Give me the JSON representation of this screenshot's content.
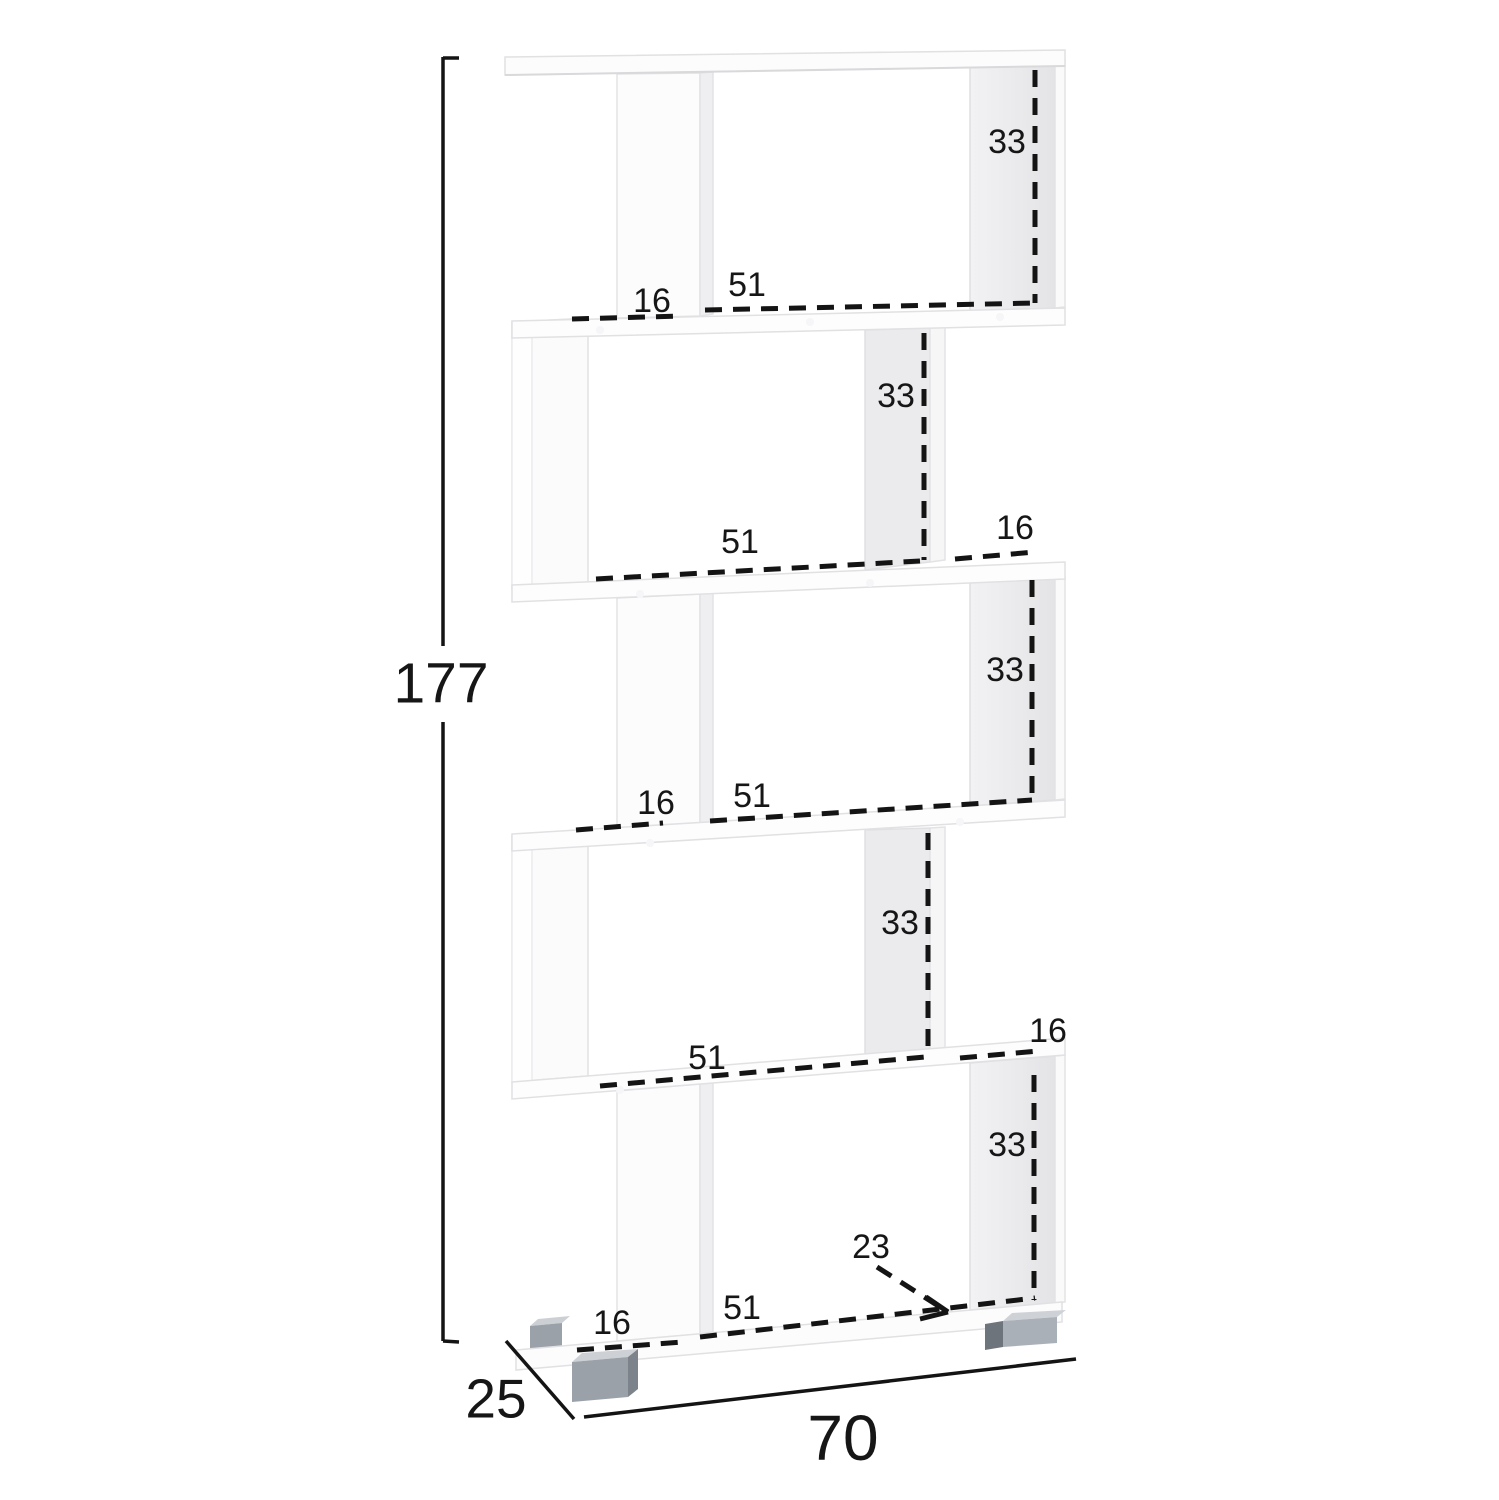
{
  "diagram": {
    "description": "Dimension diagram of a white 5-tier zig-zag bookcase with gray feet",
    "overall": {
      "height": "177",
      "depth": "25",
      "width": "70"
    },
    "tiers": [
      {
        "name": "tier-1",
        "compartment_height": "33",
        "compartment_width": "51",
        "side_gap": "16"
      },
      {
        "name": "tier-2",
        "compartment_height": "33",
        "compartment_width": "51",
        "side_gap": "16"
      },
      {
        "name": "tier-3",
        "compartment_height": "33",
        "compartment_width": "51",
        "side_gap": "16"
      },
      {
        "name": "tier-4",
        "compartment_height": "33",
        "compartment_width": "51",
        "side_gap": "16"
      },
      {
        "name": "tier-5",
        "compartment_height": "33",
        "compartment_width": "51",
        "side_gap": "16",
        "base_depth": "23"
      }
    ],
    "colors": {
      "line": "#141414",
      "panel_white": "#fcfcfd",
      "panel_inner_face": "#e9e9eb",
      "foot_front": "#9aa1a8",
      "foot_side": "#6e747b",
      "foot_top": "#ced2d7"
    }
  }
}
